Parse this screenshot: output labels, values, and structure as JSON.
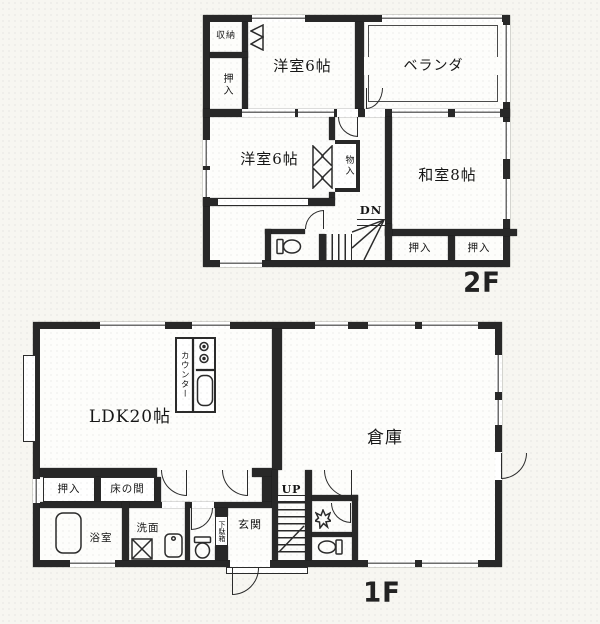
{
  "colors": {
    "paper": "#f7f6f1",
    "ink": "#1e1e1e",
    "wall": "#282828"
  },
  "floor2": {
    "label": "2F",
    "stairs": "DN",
    "rooms": {
      "closet_top": "収納",
      "oshiire_left": "押入",
      "western_room_a": "洋室6帖",
      "veranda": "ベランダ",
      "western_room_b": "洋室6帖",
      "monoire": "物入",
      "japanese_room": "和室8帖",
      "oshiire_a": "押入",
      "oshiire_b": "押入"
    },
    "fixtures": [
      "toilet",
      "folding-door",
      "winder-stairs"
    ]
  },
  "floor1": {
    "label": "1F",
    "stairs": "UP",
    "rooms": {
      "ldk": "LDK20帖",
      "counter": "カウンター",
      "warehouse": "倉庫",
      "oshiire": "押入",
      "tokonoma": "床の間",
      "bath": "浴室",
      "washroom": "洗面",
      "shoe_cabinet": "下駄箱",
      "entrance": "玄関"
    },
    "fixtures": [
      "stove-burners",
      "kitchen-sink",
      "bathtub",
      "washing-machine",
      "washbasin",
      "toilet",
      "hand-wash-basin",
      "toilet",
      "bay-window"
    ]
  }
}
